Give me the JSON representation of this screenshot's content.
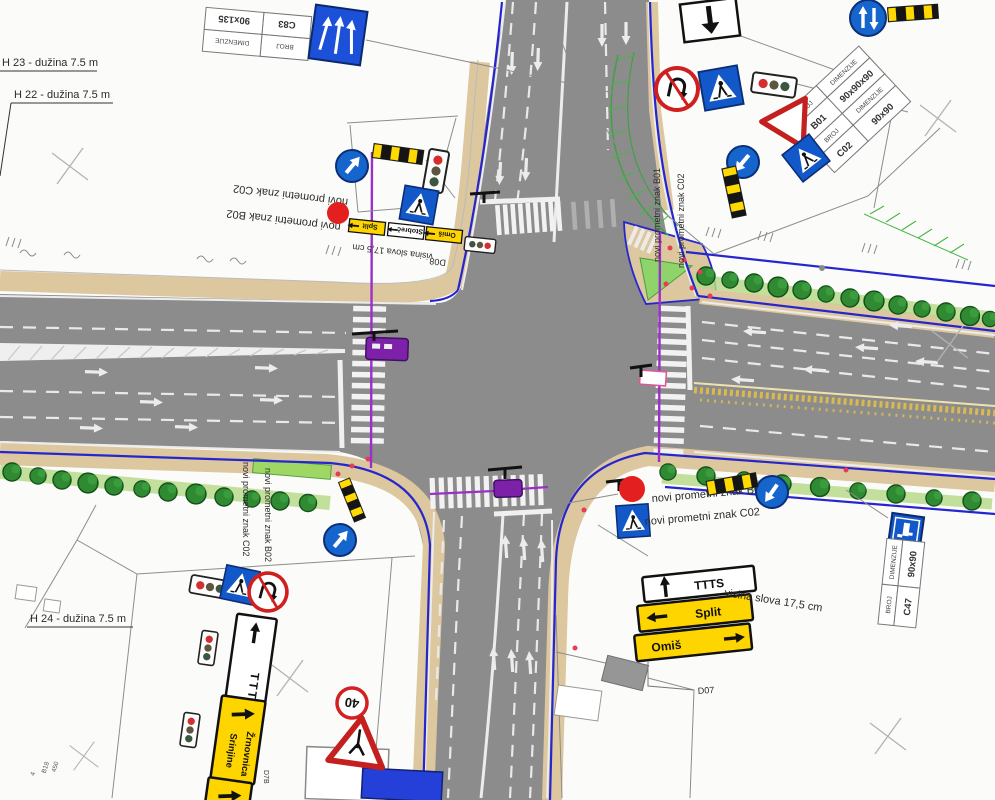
{
  "annotations": {
    "h23": "H 23 - dužina 7.5 m",
    "h22": "H 22 - dužina 7.5 m",
    "h24": "H 24 - dužina 7.5 m",
    "visina_slova": "visina slova 17,5 cm",
    "d07": "D07",
    "d08": "D08",
    "d7b": "D7B",
    "b18_n1": "4",
    "b18_code": "B18",
    "b18_num": "450"
  },
  "new_sign_labels": {
    "b01": "novi prometni znak B01",
    "b02": "novi prometni znak B02",
    "c02": "novi prometni znak C02"
  },
  "sign_tables": {
    "c83": {
      "header": [
        "BROJ",
        "DIMENZIJE"
      ],
      "row": [
        "C83",
        "90x135"
      ]
    },
    "b01": {
      "header": [
        "BROJ",
        "DIMENZIJE"
      ],
      "row": [
        "B01",
        "90x90x90"
      ]
    },
    "c02": {
      "header": [
        "BROJ",
        "DIMENZIJE"
      ],
      "row": [
        "C02",
        "90x90"
      ]
    },
    "c47": {
      "header": [
        "BROJ",
        "DIMENZIJE"
      ],
      "row": [
        "C47",
        "90x90"
      ]
    }
  },
  "direction_signs": {
    "d07_stack": {
      "line1": "TTTS",
      "line2": "Split",
      "line3": "Omiš"
    },
    "d08_stack": {
      "line1": "Split",
      "line2": "Stobreč",
      "line3": "Omiš"
    },
    "south_stack": {
      "ttts": "TTTS",
      "dest1": "Srinjine",
      "dest2": "Žrnovnica"
    }
  },
  "speed_limit_40": "40",
  "colors": {
    "road": "#8c8c8c",
    "sidewalk": "#dcc79e",
    "sign_blue": "#1358c8",
    "sign_yellow": "#ffd500",
    "curb_blue": "#2626cf",
    "marking_purple": "#9b30c9",
    "stop_red": "#e31f1f"
  }
}
